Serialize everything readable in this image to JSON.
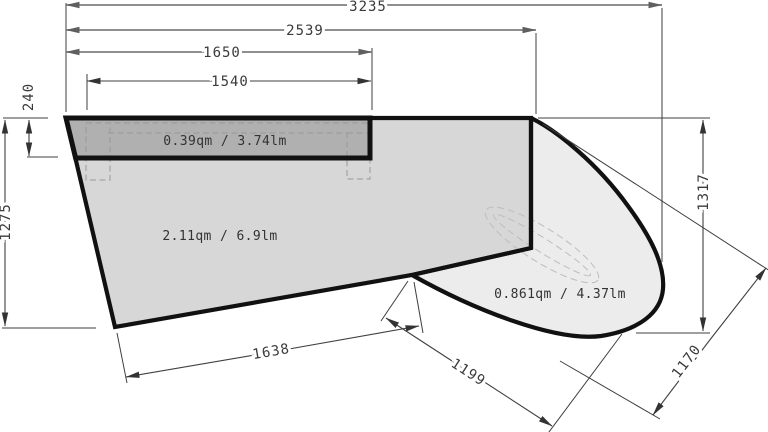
{
  "drawing": {
    "title": "panel-measurement-drawing",
    "area_labels": {
      "counter": "0.39qm / 3.74lm",
      "main": "2.11qm / 6.9lm",
      "curved": "0.861qm / 4.37lm"
    },
    "dimensions": {
      "overall_width": "3235",
      "upper_width": "2539",
      "counter_outer_width": "1650",
      "counter_inner_width": "1540",
      "counter_depth": "240",
      "left_height": "1275",
      "right_height": "1317",
      "bottom_edge": "1638",
      "notch_diagonal": "1199",
      "right_diagonal": "1170"
    },
    "colors": {
      "counter_fill": "#b0b0b0",
      "main_fill": "#d7d7d7",
      "curved_fill": "#ececec",
      "outline": "#111111",
      "dim_line": "#3f3f3f",
      "dim_gray": "#7f7f7f",
      "text": "#3a3a3a"
    }
  }
}
